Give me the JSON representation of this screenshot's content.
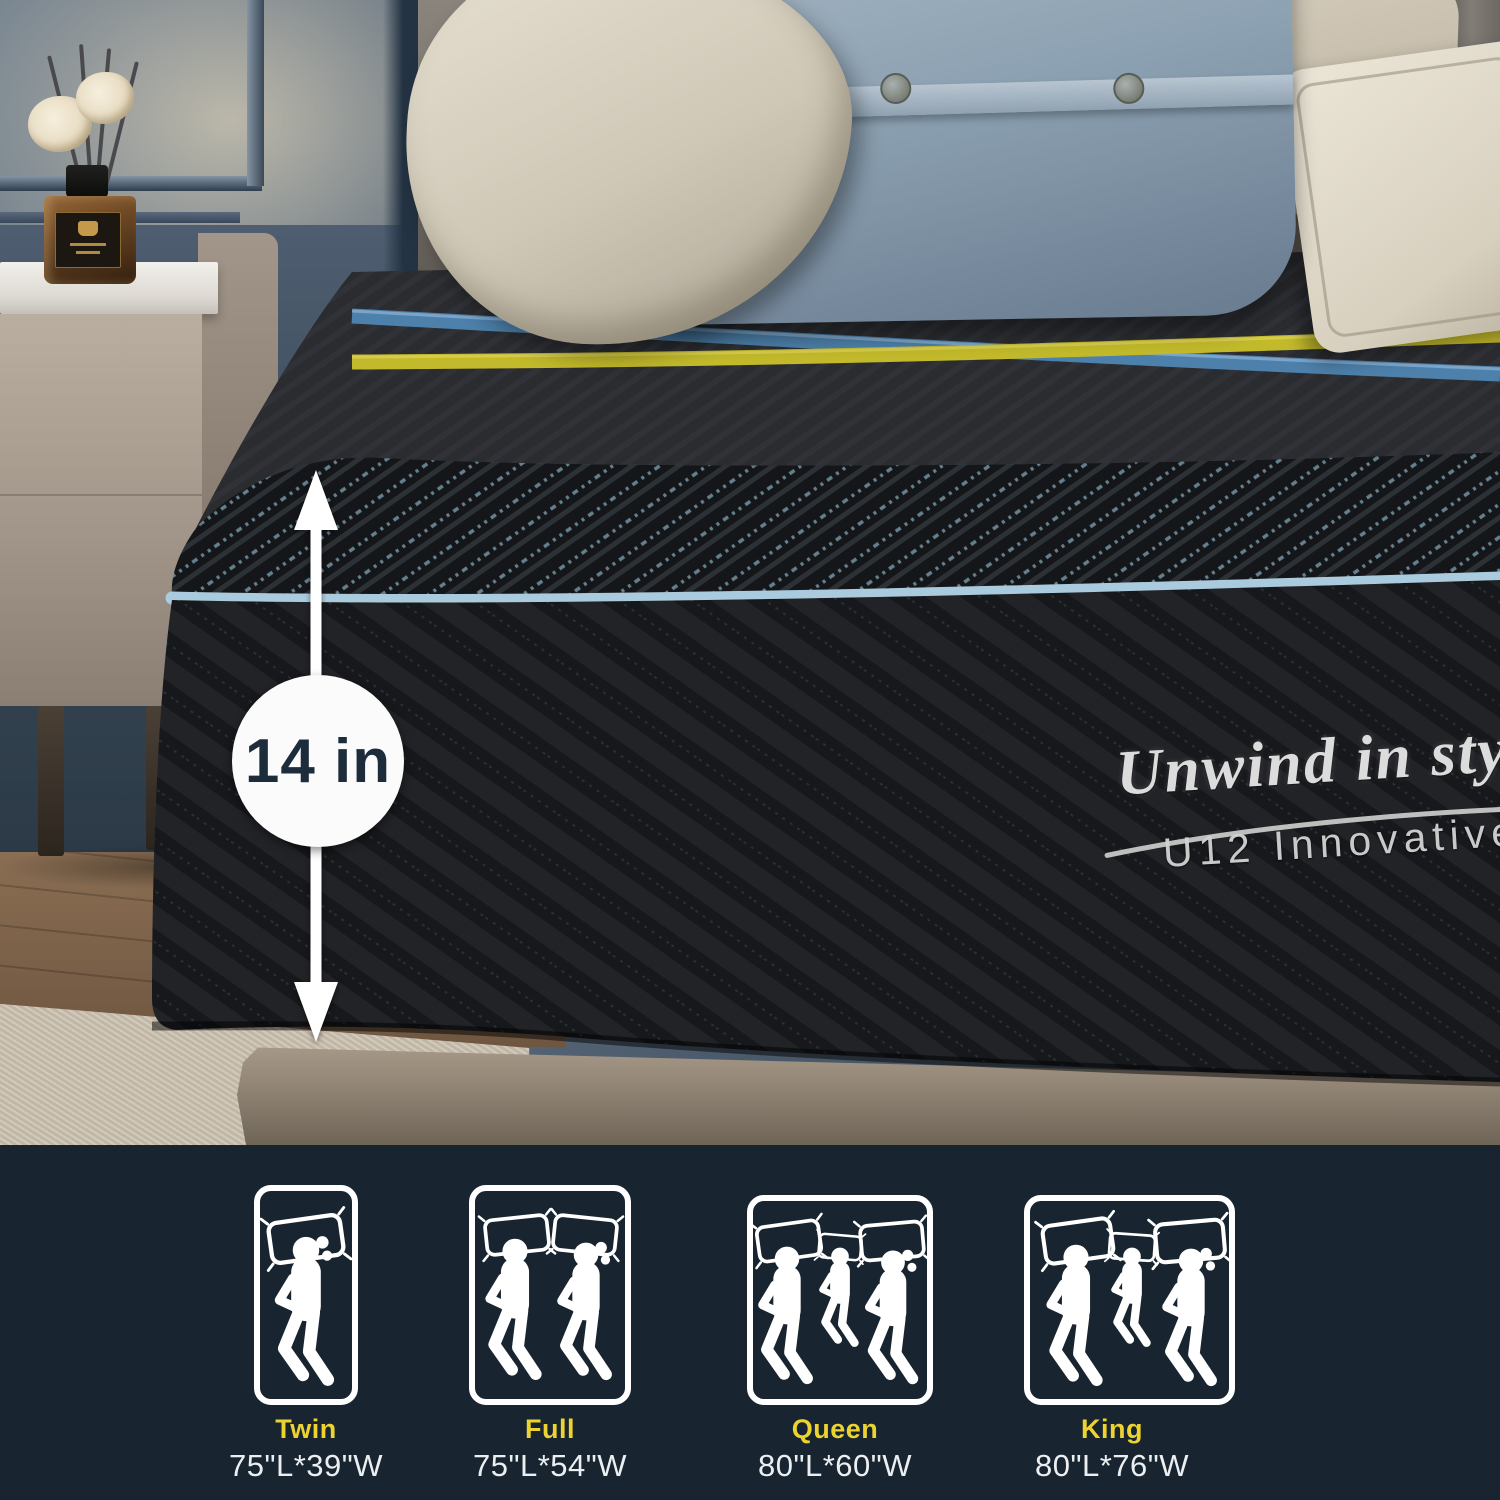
{
  "measurement": {
    "label": "14 in"
  },
  "branding": {
    "script": "Unwind in style",
    "model": "U12 Innovative"
  },
  "size_panel": {
    "sizes": [
      {
        "name": "Twin",
        "dims": "75\"L*39\"W",
        "icon": "twin-one-sleeper-icon"
      },
      {
        "name": "Full",
        "dims": "75\"L*54\"W",
        "icon": "full-two-sleepers-icon"
      },
      {
        "name": "Queen",
        "dims": "80\"L*60\"W",
        "icon": "queen-family-sleepers-icon"
      },
      {
        "name": "King",
        "dims": "80\"L*76\"W",
        "icon": "king-family-sleepers-icon"
      }
    ]
  },
  "colors": {
    "panel_bg": "#18242f",
    "size_label_yellow": "#ecd32f",
    "dims_white": "#eceff1",
    "stripe_blue": "#4d80ab",
    "stripe_yellow": "#c2b92b",
    "piping_blue": "#aacbde",
    "measurement_text": "#1d2c3b"
  }
}
